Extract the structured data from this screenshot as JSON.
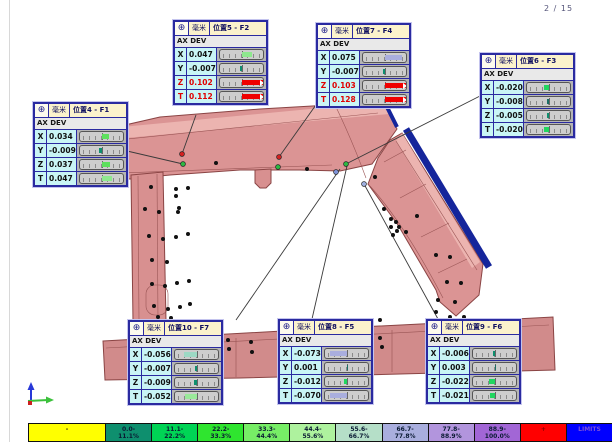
{
  "page": {
    "indicator": "2 / 15"
  },
  "units_label": "毫米",
  "ax_dev_label": "AX DEV",
  "accent_colors": {
    "callout_border": "#2a2aa0",
    "callout_title_bg": "#fbf2cc",
    "cell_cyan": "#c9f5f5",
    "alert_red": "#e00000",
    "model_pink": "#db9494",
    "edge_blue": "#15259b"
  },
  "callouts": [
    {
      "id": "F2",
      "title": "位置5 - F2",
      "x": 173,
      "y": 20,
      "rows": [
        {
          "axis": "X",
          "value": "0.047",
          "alert": false,
          "bar": {
            "pct": 47,
            "dir": "right",
            "color": "#8ee88e"
          }
        },
        {
          "axis": "Y",
          "value": "-0.007",
          "alert": false,
          "bar": {
            "pct": 7,
            "dir": "left",
            "color": "#0e8f6e"
          }
        },
        {
          "axis": "Z",
          "value": "0.102",
          "alert": true,
          "bar": {
            "pct": 100,
            "dir": "right",
            "color": "#f00000"
          }
        },
        {
          "axis": "T",
          "value": "0.112",
          "alert": true,
          "bar": {
            "pct": 100,
            "dir": "right",
            "color": "#f00000"
          }
        }
      ]
    },
    {
      "id": "F4",
      "title": "位置7 - F4",
      "x": 316,
      "y": 23,
      "rows": [
        {
          "axis": "X",
          "value": "0.075",
          "alert": false,
          "bar": {
            "pct": 75,
            "dir": "right",
            "color": "#a9aede"
          }
        },
        {
          "axis": "Y",
          "value": "-0.007",
          "alert": false,
          "bar": {
            "pct": 7,
            "dir": "left",
            "color": "#0e8f6e"
          }
        },
        {
          "axis": "Z",
          "value": "0.103",
          "alert": true,
          "bar": {
            "pct": 100,
            "dir": "right",
            "color": "#f00000"
          }
        },
        {
          "axis": "T",
          "value": "0.128",
          "alert": true,
          "bar": {
            "pct": 100,
            "dir": "right",
            "color": "#f00000"
          }
        }
      ]
    },
    {
      "id": "F3",
      "title": "位置6 - F3",
      "x": 480,
      "y": 53,
      "rows": [
        {
          "axis": "X",
          "value": "-0.020",
          "alert": false,
          "bar": {
            "pct": 20,
            "dir": "left",
            "color": "#21d65f"
          }
        },
        {
          "axis": "Y",
          "value": "-0.008",
          "alert": false,
          "bar": {
            "pct": 8,
            "dir": "left",
            "color": "#1b6f66"
          }
        },
        {
          "axis": "Z",
          "value": "-0.005",
          "alert": false,
          "bar": {
            "pct": 5,
            "dir": "left",
            "color": "#0e8f6e"
          }
        },
        {
          "axis": "T",
          "value": "-0.020",
          "alert": false,
          "bar": {
            "pct": 20,
            "dir": "left",
            "color": "#21d65f"
          }
        }
      ]
    },
    {
      "id": "F1",
      "title": "位置4 - F1",
      "x": 33,
      "y": 102,
      "rows": [
        {
          "axis": "X",
          "value": "0.034",
          "alert": false,
          "bar": {
            "pct": 34,
            "dir": "right",
            "color": "#5ce05c"
          }
        },
        {
          "axis": "Y",
          "value": "-0.009",
          "alert": false,
          "bar": {
            "pct": 9,
            "dir": "left",
            "color": "#0e8f6e"
          }
        },
        {
          "axis": "Z",
          "value": "0.037",
          "alert": false,
          "bar": {
            "pct": 37,
            "dir": "right",
            "color": "#5ce05c"
          }
        },
        {
          "axis": "T",
          "value": "0.047",
          "alert": false,
          "bar": {
            "pct": 47,
            "dir": "right",
            "color": "#8ee88e"
          }
        }
      ]
    },
    {
      "id": "F7",
      "title": "位置10 - F7",
      "x": 128,
      "y": 320,
      "rows": [
        {
          "axis": "X",
          "value": "-0.056",
          "alert": false,
          "bar": {
            "pct": 56,
            "dir": "left",
            "color": "#9cd9c4"
          }
        },
        {
          "axis": "Y",
          "value": "-0.007",
          "alert": false,
          "bar": {
            "pct": 7,
            "dir": "left",
            "color": "#0e8f6e"
          }
        },
        {
          "axis": "Z",
          "value": "-0.009",
          "alert": false,
          "bar": {
            "pct": 9,
            "dir": "left",
            "color": "#0e8f6e"
          }
        },
        {
          "axis": "T",
          "value": "-0.052",
          "alert": false,
          "bar": {
            "pct": 52,
            "dir": "left",
            "color": "#9ae99a"
          }
        }
      ]
    },
    {
      "id": "F5",
      "title": "位置8 - F5",
      "x": 278,
      "y": 319,
      "rows": [
        {
          "axis": "X",
          "value": "-0.073",
          "alert": false,
          "bar": {
            "pct": 73,
            "dir": "left",
            "color": "#a9aede"
          }
        },
        {
          "axis": "Y",
          "value": "0.001",
          "alert": false,
          "bar": {
            "pct": 2,
            "dir": "right",
            "color": "#1b6f66"
          }
        },
        {
          "axis": "Z",
          "value": "-0.012",
          "alert": false,
          "bar": {
            "pct": 12,
            "dir": "left",
            "color": "#21d65f"
          }
        },
        {
          "axis": "T",
          "value": "-0.070",
          "alert": false,
          "bar": {
            "pct": 70,
            "dir": "left",
            "color": "#a9aede"
          }
        }
      ]
    },
    {
      "id": "F6",
      "title": "位置9 - F6",
      "x": 426,
      "y": 319,
      "rows": [
        {
          "axis": "X",
          "value": "-0.006",
          "alert": false,
          "bar": {
            "pct": 6,
            "dir": "left",
            "color": "#0e8f6e"
          }
        },
        {
          "axis": "Y",
          "value": "0.003",
          "alert": false,
          "bar": {
            "pct": 3,
            "dir": "right",
            "color": "#1b6f66"
          }
        },
        {
          "axis": "Z",
          "value": "-0.022",
          "alert": false,
          "bar": {
            "pct": 22,
            "dir": "left",
            "color": "#21d65f"
          }
        },
        {
          "axis": "T",
          "value": "-0.021",
          "alert": false,
          "bar": {
            "pct": 21,
            "dir": "left",
            "color": "#21d65f"
          }
        }
      ]
    }
  ],
  "color_scale": [
    {
      "line1": "-",
      "line2": "",
      "bg": "#ffff00",
      "fg": "#1a1a1a"
    },
    {
      "line1": "0.0-",
      "line2": "11.1%",
      "bg": "#0e8f6e",
      "fg": "#0a1a33"
    },
    {
      "line1": "11.1-",
      "line2": "22.2%",
      "bg": "#00d455",
      "fg": "#0a1a33"
    },
    {
      "line1": "22.2-",
      "line2": "33.3%",
      "bg": "#2fe52f",
      "fg": "#0a1a33"
    },
    {
      "line1": "33.3-",
      "line2": "44.4%",
      "bg": "#77ee66",
      "fg": "#0a1a33"
    },
    {
      "line1": "44.4-",
      "line2": "55.6%",
      "bg": "#aef29e",
      "fg": "#0a1a33"
    },
    {
      "line1": "55.6-",
      "line2": "66.7%",
      "bg": "#b5dfc8",
      "fg": "#0a1a33"
    },
    {
      "line1": "66.7-",
      "line2": "77.8%",
      "bg": "#a9aede",
      "fg": "#0a1a33"
    },
    {
      "line1": "77.8-",
      "line2": "88.9%",
      "bg": "#b295dd",
      "fg": "#0a1a33"
    },
    {
      "line1": "88.9-",
      "line2": "100.0%",
      "bg": "#a266d6",
      "fg": "#0a1a33"
    },
    {
      "line1": "+",
      "line2": "",
      "bg": "#ff0000",
      "fg": "#8a0000"
    },
    {
      "line1": "LIMITS",
      "line2": "",
      "bg": "#0000ff",
      "fg": "#7a4fd8"
    }
  ]
}
